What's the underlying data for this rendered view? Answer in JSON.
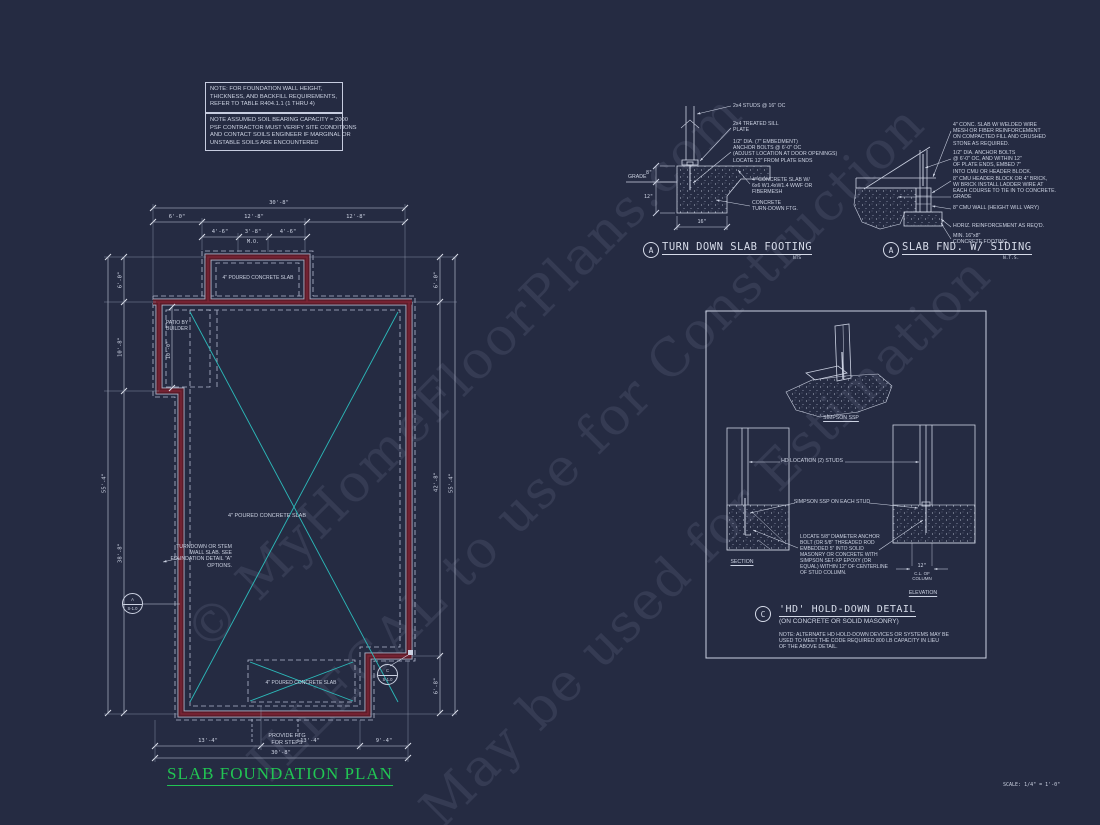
{
  "sheet": {
    "title": "SLAB FOUNDATION PLAN",
    "scale_note": "SCALE: 1/4\" = 1'-0\""
  },
  "watermark": {
    "line1": "© MyHomeFloorPlans.com",
    "line2": "ILLEGAL to use for Construction",
    "line3": "May be used for Estimation"
  },
  "notes": {
    "note1": "NOTE: FOR FOUNDATION WALL HEIGHT,\nTHICKNESS, AND BACKFILL REQUIREMENTS,\nREFER TO TABLE R404.1.1 (1 THRU 4)",
    "note2": "NOTE ASSUMED SOIL BEARING CAPACITY = 2000\nPSF CONTRACTOR MUST VERIFY SITE CONDITIONS\nAND CONTACT SOILS ENGINEER IF MARGINAL OR\nUNSTABLE SOILS ARE ENCOUNTERED"
  },
  "plan": {
    "labels": {
      "slab_top": "4\" POURED CONCRETE SLAB",
      "slab_main": "4\" POURED CONCRETE SLAB",
      "slab_porch": "4\" POURED CONCRETE SLAB",
      "patio": "PATIO BY\nBUILDER",
      "turndown_note": "TURNDOWN OR STEM\nWALL SLAB. SEE\nFOUNDATION DETAIL \"A\"\nOPTIONS.",
      "steps_note": "PROVIDE FTG\nFOR STEPS",
      "bubble_a_letter": "A",
      "bubble_a_sheet": "S-1.0",
      "bubble_c_letter": "C",
      "bubble_c_sheet": "S-1.0"
    },
    "dims": {
      "t_overall": "30'-8\"",
      "t_a": "6'-0\"",
      "t_b": "12'-8\"",
      "t_c": "12'-8\"",
      "t_d": "4'-6\"",
      "t_e": "3'-8\"",
      "t_f": "4'-6\"",
      "t_mo": "M.O.",
      "l_overall": "55'-4\"",
      "l_a": "6'-0\"",
      "l_b": "10'-8\"",
      "l_c": "38'-8\"",
      "patio": "10'-0\"",
      "r_a": "6'-0\"",
      "r_b": "42'-8\"",
      "r_c": "6'-8\"",
      "r_overall": "55'-4\"",
      "b_a": "13'-4\"",
      "b_b": "13'-4\"",
      "b_c": "9'-4\"",
      "b_overall": "30'-8\""
    }
  },
  "detail_turndown": {
    "bubble": "A",
    "title": "TURN DOWN SLAB FOOTING",
    "scale": "NTS",
    "grade": "GRADE",
    "dim_8": "8\"",
    "dim_12": "12\"",
    "dim_16": "16\"",
    "callout_studs": "2x4 STUDS @ 16\" OC",
    "callout_sill": "2x4 TREATED SILL\nPLATE",
    "callout_bolt": "1/2\" DIA. (7\" EMBEDMENT)\nANCHOR BOLTS @ 6'-0\" OC\n(ADJUST LOCATION AT DOOR OPENINGS)\nLOCATE 12\" FROM PLATE ENDS",
    "callout_slab": "4\" CONCRETE SLAB W/\n6x6 W1.4xW1.4 WWF OR\nFIBERMESH",
    "callout_ftg": "CONCRETE\nTURN-DOWN FTG."
  },
  "detail_siding": {
    "bubble": "A",
    "title": "SLAB FND. W/ SIDING",
    "scale": "N.T.S.",
    "grade": "GRADE",
    "callout_slab": "4\" CONC. SLAB W/ WELDED WIRE\nMESH OR FIBER REINFORCEMENT\nON COMPACTED FILL AND CRUSHED\nSTONE AS REQUIRED.",
    "callout_bolt": "1/2\" DIA. ANCHOR BOLTS\n@ 6'-0\" OC, AND WITHIN 12\"\nOF PLATE ENDS, EMBED 7\"\nINTO CMU OR HEADER BLOCK.",
    "callout_cmu": "8\" CMU HEADER BLOCK OR 4\" BRICK,\nW/ BRICK INSTALL LADDER WIRE AT\nEACH COURSE TO TIE IN TO CONCRETE.",
    "callout_wall": "8\" CMU WALL (HEIGHT WILL VARY)",
    "callout_reinf": "HORIZ. REINFORCEMENT AS REQ'D.",
    "callout_ftg": "MIN. 16\"x8\"\nCONCRETE FOOTING"
  },
  "detail_hd": {
    "bubble": "C",
    "title": "'HD' HOLD-DOWN DETAIL",
    "subtitle": "(ON CONCRETE OR SOLID MASONRY)",
    "simpson_label": "SIMPSON SSP",
    "hd_location": "HD LOCATION (2) STUDS",
    "ssp_each": "SIMPSON SSP ON EACH STUD",
    "locate_note": "LOCATE 5/8\" DIAMETER ANCHOR\nBOLT (OR 5/8\" THREADED ROD\nEMBEDDED 5\" INTO SOLID\nMASONRY OR CONCRETE WITH\nSIMPSON SET-XP EPOXY (OR\nEQUAL) WITHIN 12\" OF CENTERLINE\nOF STUD COLUMN.",
    "section_label": "SECTION",
    "elevation_label": "ELEVATION",
    "dim_12": "12\"",
    "cl_note": "C.L. OF\nCOLUMN",
    "note": "NOTE: ALTERNATE HD HOLD-DOWN DEVICES OR SYSTEMS MAY BE\nUSED TO MEET THE CODE REQUIRED 800 LB CAPACITY IN LIEU\nOF THE ABOVE DETAIL."
  },
  "colors": {
    "background": "#252b42",
    "wall_red": "#5d1b29",
    "line": "#c7cde0",
    "slab_cyan": "#2cb9b9",
    "title_green": "#21c553"
  }
}
